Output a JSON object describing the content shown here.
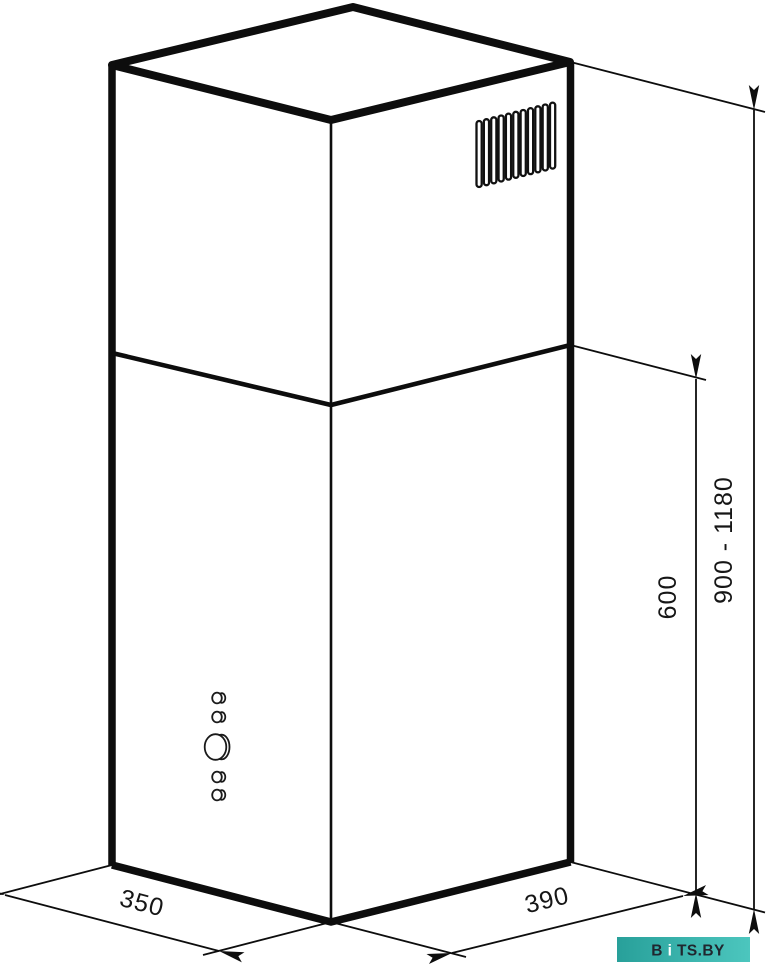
{
  "diagram": {
    "subject": "island-range-hood-dimension-drawing",
    "line_color": "#0d0d0d",
    "background": "#ffffff"
  },
  "dimensions": {
    "width": {
      "value": "350"
    },
    "depth": {
      "value": "390"
    },
    "body_height": {
      "value": "600"
    },
    "total_height": {
      "value": "900 - 1180"
    }
  },
  "features": {
    "vent_grille": {
      "slot_count": 11
    },
    "control_panel": {
      "button_count": 5,
      "buttons": [
        "small",
        "small",
        "knob",
        "small",
        "small"
      ]
    }
  },
  "logo": {
    "part1": "B",
    "part2": "i",
    "part3": "TS.BY",
    "bg_from": "#28a09a",
    "bg_to": "#4cc6be",
    "text_color": "#20262e",
    "accent_color": "#ffffff"
  }
}
